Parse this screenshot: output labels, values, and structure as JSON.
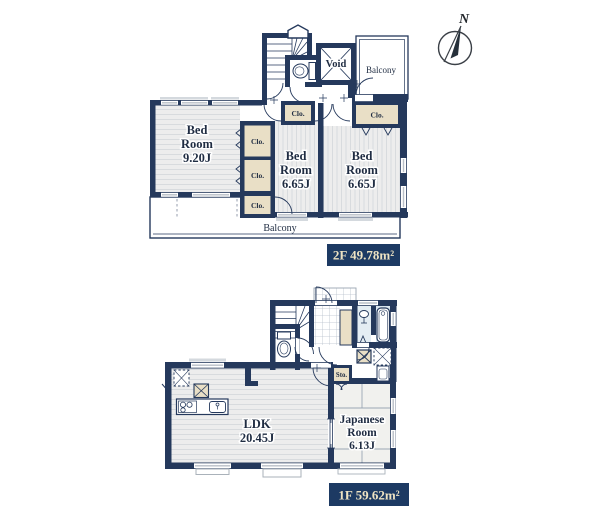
{
  "compass": {
    "north": "N"
  },
  "floor_2f": {
    "badge": "2F 49.78m²",
    "bedroom_main": [
      "Bed",
      "Room",
      "9.20J"
    ],
    "bedroom_center": [
      "Bed",
      "Room",
      "6.65J"
    ],
    "bedroom_right": [
      "Bed",
      "Room",
      "6.65J"
    ],
    "void": "Void",
    "balcony_top": "Balcony",
    "balcony_bottom": "Balcony",
    "closet_hall": "Clo.",
    "closet_right": "Clo.",
    "closet_upper": "Clo.",
    "closet_lower": "Clo.",
    "closet_bottom": "Clo."
  },
  "floor_1f": {
    "badge": "1F 59.62m²",
    "ldk": [
      "LDK",
      "20.45J"
    ],
    "japanese_room": [
      "Japanese",
      "Room",
      "6.13J"
    ],
    "storage": "Sto."
  },
  "colors": {
    "wall": "#25395c",
    "closet_fill": "#e9dfc6",
    "floor_fill": "#ededed",
    "bath_floor": "#e3edf3",
    "badge_bg": "#1d3a63",
    "badge_text": "#eee3c3"
  }
}
